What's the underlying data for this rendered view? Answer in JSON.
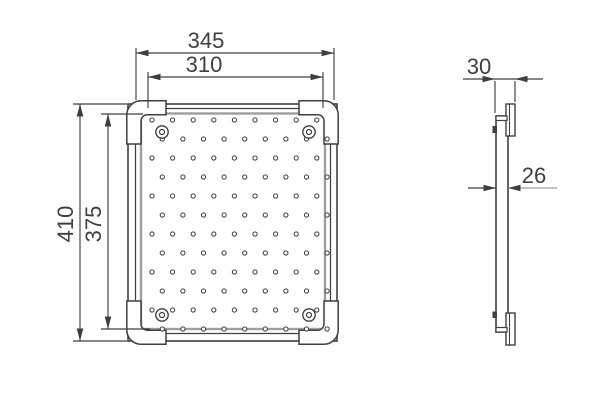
{
  "drawing": {
    "type": "technical-dimension-drawing",
    "colors": {
      "line": "#3f3f3f",
      "shade": "#9e9e9e",
      "background": "#ffffff"
    },
    "front_view": {
      "dim_width_outer": "345",
      "dim_width_inner": "310",
      "dim_height_outer": "410",
      "dim_height_inner": "375",
      "perforations": {
        "rows": 12,
        "cols": 9,
        "x_start": 152,
        "y_start": 120,
        "x_pitch": 20.6,
        "y_pitch": 19.0,
        "stagger_offset": 10.3,
        "dot_radius": 2.1
      },
      "rivets": {
        "outer_radius": 6.2,
        "inner_radius": 2.5,
        "positions": [
          {
            "x": 162,
            "y": 132
          },
          {
            "x": 309,
            "y": 132
          },
          {
            "x": 162,
            "y": 315
          },
          {
            "x": 309,
            "y": 315
          }
        ]
      }
    },
    "side_view": {
      "dim_thickness_outer": "30",
      "dim_thickness_inner": "26"
    }
  }
}
